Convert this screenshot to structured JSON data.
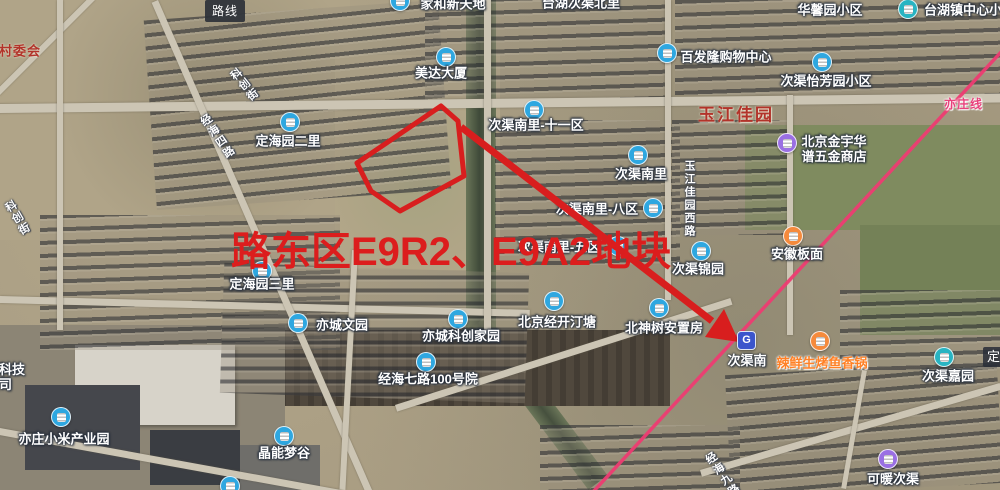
{
  "controls": {
    "route_button": "路线"
  },
  "annotation": {
    "text": "路东区E9R2、E9A2地块",
    "color": "#dc1d1d"
  },
  "metro": {
    "line_label": "亦庄线",
    "line_color": "#ee3c72",
    "station": {
      "name": "次渠南",
      "glyph": "G"
    }
  },
  "edge_partial_label": "定",
  "colors": {
    "blue": "#2ea7e0",
    "teal": "#28b4c2",
    "purple": "#9a6fe3",
    "orange": "#f58a3c",
    "school": "#28b4c2",
    "food": "#f58a3c"
  },
  "pois": [
    {
      "text": "家和新天地",
      "type": "blue",
      "ix": 400,
      "iy": 1,
      "tx": 453,
      "ty": 4
    },
    {
      "text": "台湖次渠北里",
      "type": "plain",
      "tx": 581,
      "ty": 3
    },
    {
      "text": "华馨园小区",
      "type": "plain",
      "tx": 830,
      "ty": 10
    },
    {
      "text": "台湖镇中心小",
      "type": "school",
      "ix": 908,
      "iy": 9,
      "tx": 963,
      "ty": 10
    },
    {
      "text": "美达大厦",
      "type": "blue",
      "ix": 446,
      "iy": 57,
      "tx": 441,
      "ty": 73
    },
    {
      "text": "百发隆购物中心",
      "type": "blue",
      "ix": 667,
      "iy": 53,
      "tx": 726,
      "ty": 57
    },
    {
      "text": "次渠怡芳园小区",
      "type": "blue",
      "ix": 822,
      "iy": 62,
      "tx": 826,
      "ty": 81
    },
    {
      "text": "玉江佳园",
      "type": "area",
      "tx": 736,
      "ty": 115
    },
    {
      "text": "北京金宇华",
      "text2": "谱五金商店",
      "type": "purple",
      "ix": 787,
      "iy": 143,
      "tx": 834,
      "ty": 149
    },
    {
      "text": "次渠南里-十一区",
      "type": "blue",
      "ix": 534,
      "iy": 110,
      "tx": 536,
      "ty": 125
    },
    {
      "text": "次渠南里",
      "type": "blue",
      "ix": 638,
      "iy": 155,
      "tx": 641,
      "ty": 174
    },
    {
      "text": "次渠南里-八区",
      "type": "blue",
      "ix": 653,
      "iy": 208,
      "tx": 597,
      "ty": 209
    },
    {
      "text": "次渠南里-五区",
      "type": "blue",
      "ix": 618,
      "iy": 246,
      "tx": 559,
      "ty": 247
    },
    {
      "text": "次渠锦园",
      "type": "blue",
      "ix": 701,
      "iy": 251,
      "tx": 698,
      "ty": 269
    },
    {
      "text": "安徽板面",
      "type": "orange",
      "ix": 793,
      "iy": 236,
      "tx": 797,
      "ty": 254
    },
    {
      "text": "定海园二里",
      "type": "blue",
      "ix": 290,
      "iy": 122,
      "tx": 288,
      "ty": 141
    },
    {
      "text": "定海园三里",
      "type": "blue",
      "ix": 262,
      "iy": 271,
      "tx": 262,
      "ty": 284
    },
    {
      "text": "亦城文园",
      "type": "blue",
      "ix": 298,
      "iy": 323,
      "tx": 342,
      "ty": 325
    },
    {
      "text": "亦城科创家园",
      "type": "blue",
      "ix": 458,
      "iy": 319,
      "tx": 461,
      "ty": 336
    },
    {
      "text": "北京经开汀塘",
      "type": "blue",
      "ix": 554,
      "iy": 301,
      "tx": 557,
      "ty": 322
    },
    {
      "text": "北神树安置房",
      "type": "blue",
      "ix": 659,
      "iy": 308,
      "tx": 664,
      "ty": 328
    },
    {
      "text": "经海七路100号院",
      "type": "blue",
      "ix": 426,
      "iy": 362,
      "tx": 428,
      "ty": 379
    },
    {
      "text": "辣鲜生烤鱼香锅",
      "type": "food",
      "ix": 820,
      "iy": 341,
      "tx": 822,
      "ty": 363
    },
    {
      "text": "次渠嘉园",
      "type": "teal",
      "ix": 944,
      "iy": 357,
      "tx": 948,
      "ty": 376
    },
    {
      "text": "可暖次渠",
      "type": "purple",
      "ix": 888,
      "iy": 459,
      "tx": 893,
      "ty": 479
    },
    {
      "text": "晶能梦谷",
      "type": "blue",
      "ix": 284,
      "iy": 436,
      "tx": 284,
      "ty": 453
    },
    {
      "text": "亦庄小米产业园",
      "type": "blue",
      "ix": 61,
      "iy": 417,
      "tx": 64,
      "ty": 439
    },
    {
      "text": "村委会",
      "type": "area-sm",
      "tx": 20,
      "ty": 51
    },
    {
      "text": "储科技",
      "text2": "公司",
      "type": "cutleft",
      "tx": -14,
      "ty": 362
    },
    {
      "text": "",
      "type": "halficon",
      "ix": 230,
      "iy": 486
    }
  ],
  "road_labels": [
    {
      "text": "科创街",
      "x": 236,
      "y": 66,
      "rot": -38
    },
    {
      "text": "经海四路",
      "x": 209,
      "y": 111,
      "rot": -35
    },
    {
      "text": "科创街",
      "x": 9,
      "y": 199,
      "rot": -30
    },
    {
      "text": "玉江佳园西路",
      "x": 681,
      "y": 160,
      "rot": 0
    },
    {
      "text": "经海九路",
      "x": 714,
      "y": 449,
      "rot": -35
    }
  ]
}
